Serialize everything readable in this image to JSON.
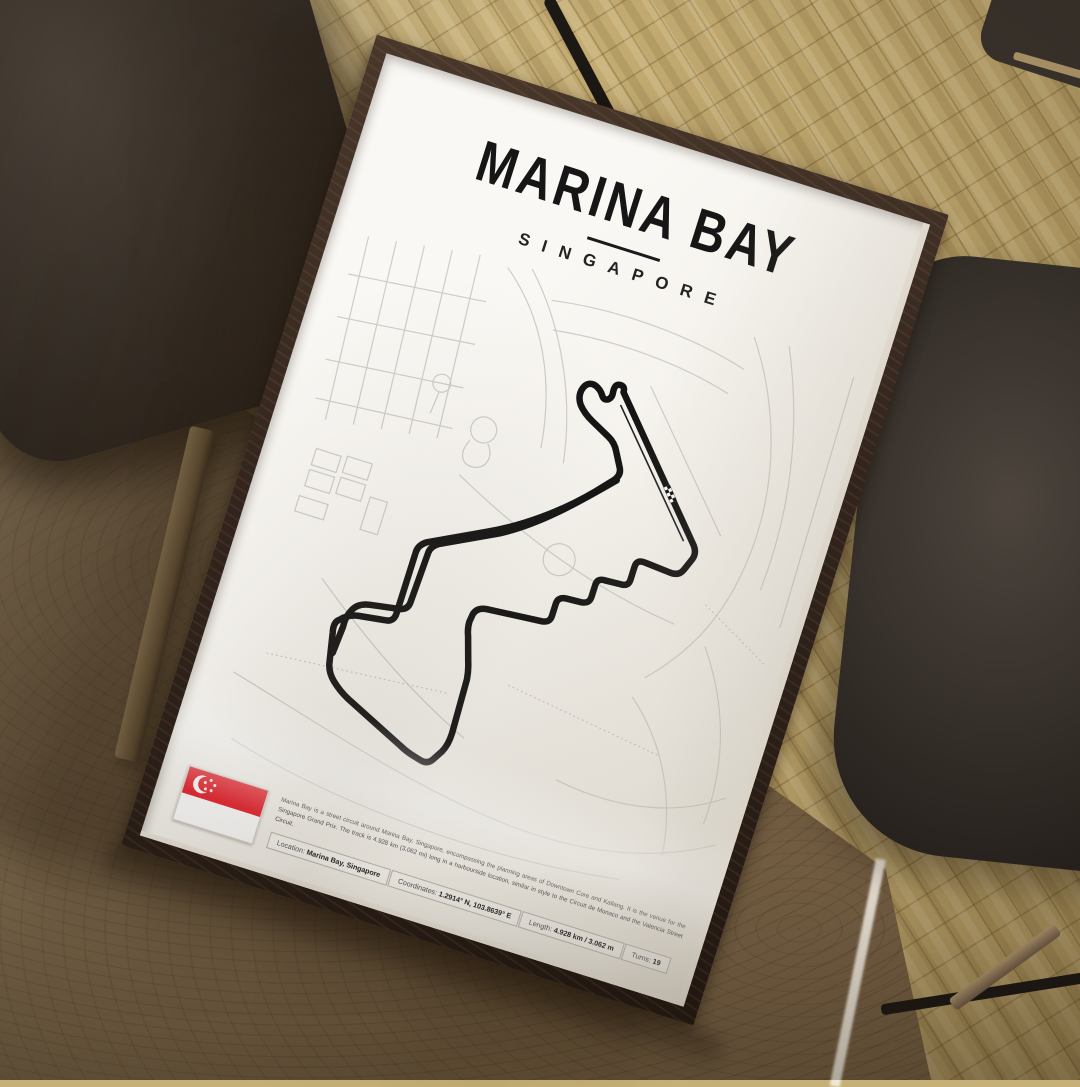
{
  "poster": {
    "title": "MARINA BAY",
    "subtitle": "SINGAPORE",
    "description": "Marina Bay is a street circuit around Marina Bay, Singapore, encompassing the planning areas of Downtown Core and Kallang. It is the venue for the Singapore Grand Prix. The track is 4.928 km (3.062 mi) long in a harbourside location, similar in style to the Circuit de Monaco and the Valencia Street Circuit.",
    "details": [
      {
        "label": "Location:",
        "value": "Marina Bay, Singapore"
      },
      {
        "label": "Coordinates:",
        "value": "1.2914° N, 103.8639° E"
      },
      {
        "label": "Length:",
        "value": "4.928 km / 3.062 m"
      },
      {
        "label": "Turns:",
        "value": "19"
      }
    ],
    "icons": {
      "flag": "singapore-flag-icon",
      "start_finish": "checkered-start-finish-icon"
    },
    "colors": {
      "track": "#141414",
      "streets": "#cfcdc8",
      "flag_red": "#e8212e",
      "frame_wood": "#33251d",
      "paper": "#f7f5f0"
    }
  }
}
